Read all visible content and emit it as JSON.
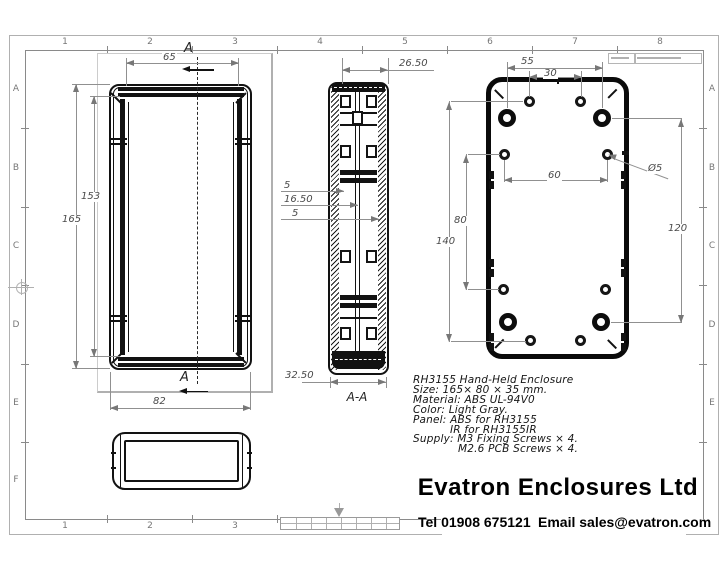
{
  "grid": {
    "top": [
      "1",
      "2",
      "3",
      "4",
      "5",
      "6",
      "7",
      "8"
    ],
    "bottom": [
      "1",
      "2",
      "3"
    ],
    "left": [
      "A",
      "B",
      "C",
      "D",
      "E",
      "F"
    ],
    "right": [
      "A",
      "B",
      "C",
      "D",
      "E"
    ]
  },
  "front_view": {
    "section_label_top": "A",
    "section_label_bottom": "A",
    "dim_lid_width": "65",
    "dim_overall_height": "165",
    "dim_inner_height": "153",
    "dim_overall_width": "82"
  },
  "section_view": {
    "label": "A-A",
    "dim_lid_depth": "26.50",
    "dim_base_depth": "32.50",
    "dim_slot_a": "5",
    "dim_slot_center": "16.50",
    "dim_slot_b": "5"
  },
  "back_view": {
    "dim_fix_holes_span": "55",
    "dim_top_holes_span": "30",
    "dim_mid_holes_span": "60",
    "dim_vertical_80": "80",
    "dim_vertical_140": "140",
    "dim_vertical_120": "120",
    "dim_hole_dia": "Ø5"
  },
  "notes": {
    "lines": [
      "RH3155 Hand-Held Enclosure",
      "Size: 165× 80 × 35 mm.",
      "Material: ABS UL-94V0",
      "Color: Light Gray.",
      "Panel: ABS for RH3155",
      "IR for RH3155IR",
      "Supply: M3 Fixing Screws × 4.",
      "M2.6 PCB Screws × 4."
    ]
  },
  "title_block": {
    "company": "Evatron Enclosures Ltd",
    "tel": "Tel 01908 675121",
    "email": "Email sales@evatron.com"
  },
  "colors": {
    "part_line": "#121212",
    "dim_line": "#8a8a8a",
    "frame_line": "#9a9a9a",
    "shadow": "#b0b0b0",
    "background": "#ffffff"
  }
}
